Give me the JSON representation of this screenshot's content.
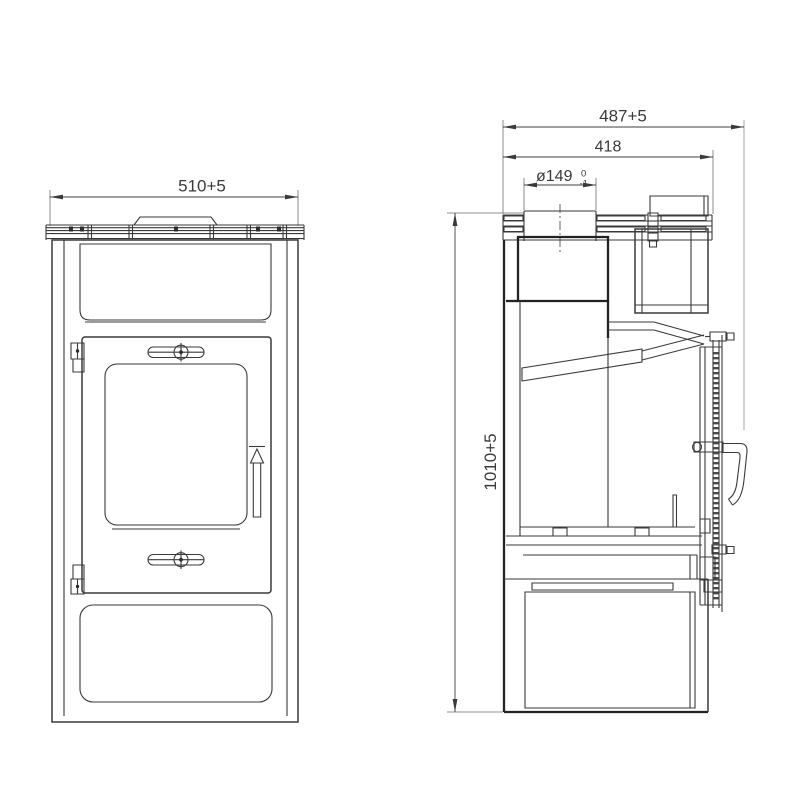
{
  "drawing": {
    "type": "stove technical drawing, front and side sectional views",
    "dimensions": {
      "front_width": "510+5",
      "side_total_depth": "487+5",
      "side_body_depth": "418",
      "flue_diameter": "ø149",
      "flue_tolerance_upper": "0",
      "flue_tolerance_lower": "-1",
      "height": "1010+5"
    },
    "colors": {
      "line": "#3a3a3a",
      "thick_line": "#222222",
      "extension_line": "#9a9a9a",
      "background": "#ffffff"
    }
  }
}
